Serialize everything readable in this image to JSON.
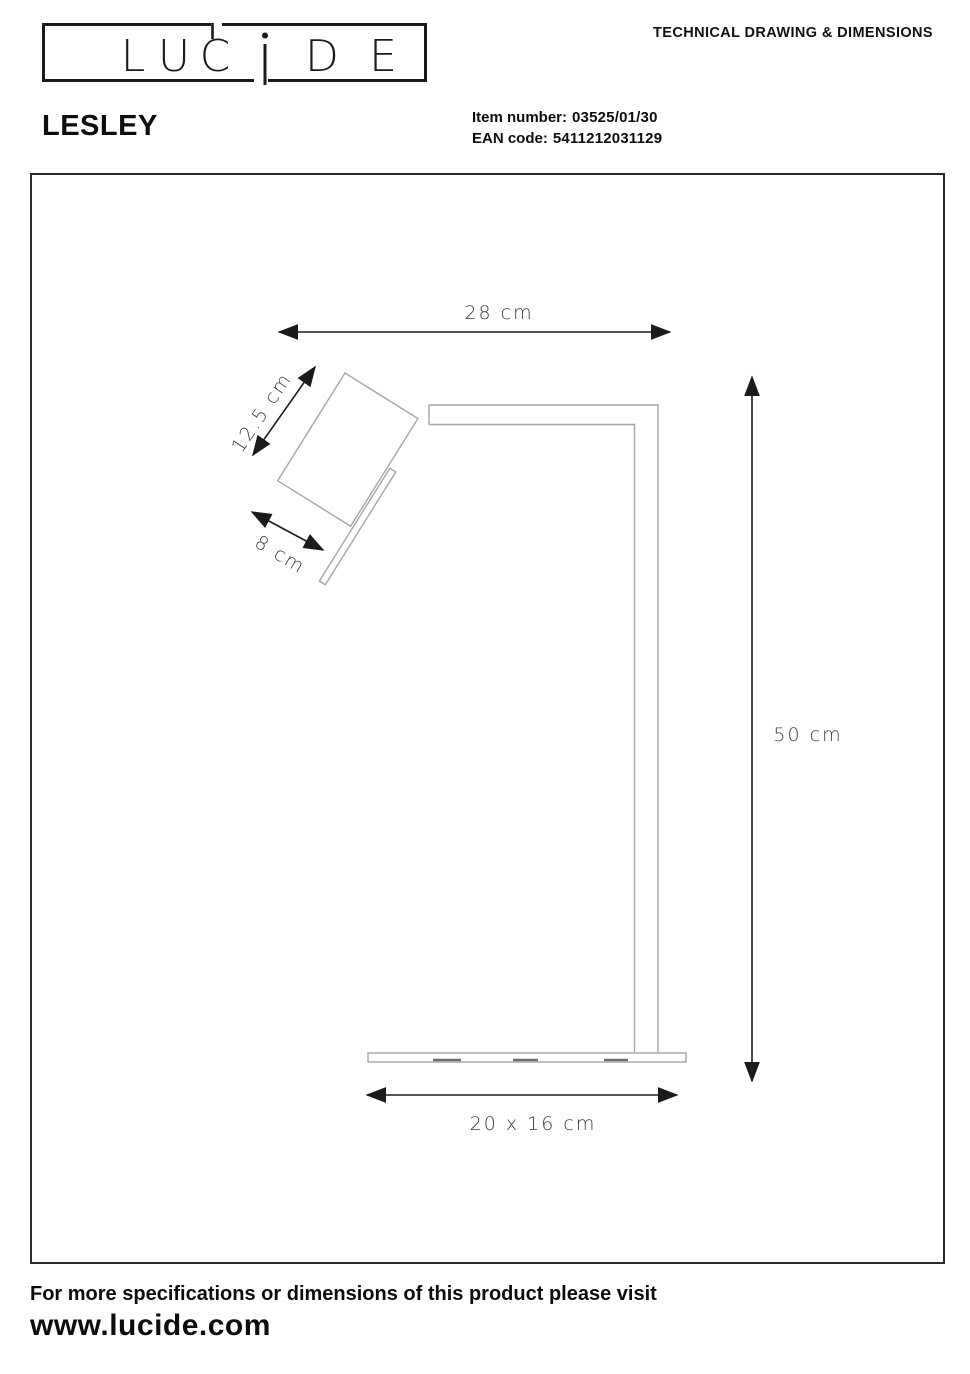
{
  "header": {
    "doc_title": "TECHNICAL DRAWING & DIMENSIONS",
    "logo_name": "LUCIDE",
    "logo_letters": {
      "l1": "L",
      "l2": "U",
      "l3": "C",
      "l4": "D",
      "l5": "E"
    }
  },
  "product": {
    "name": "LESLEY",
    "item_number_label": "Item number:",
    "item_number": "03525/01/30",
    "ean_label": "EAN code:",
    "ean": "5411212031129"
  },
  "drawing": {
    "description": "Side-view technical line drawing of the LESLEY desk lamp: tilted rectangular spot head with handle, L-shaped arm and post, flat rectangular base",
    "dimensions": {
      "arm_reach": "28 cm",
      "head_length": "12.5 cm",
      "head_width": "8 cm",
      "height": "50 cm",
      "base": "20 x 16 cm"
    },
    "colors": {
      "lamp_outline": "#a6a6a6",
      "dimension_lines": "#1b1b1b",
      "label_text": "#3d3d3d"
    }
  },
  "footer": {
    "note": "For more specifications or dimensions of this product please visit",
    "url": "www.lucide.com"
  }
}
